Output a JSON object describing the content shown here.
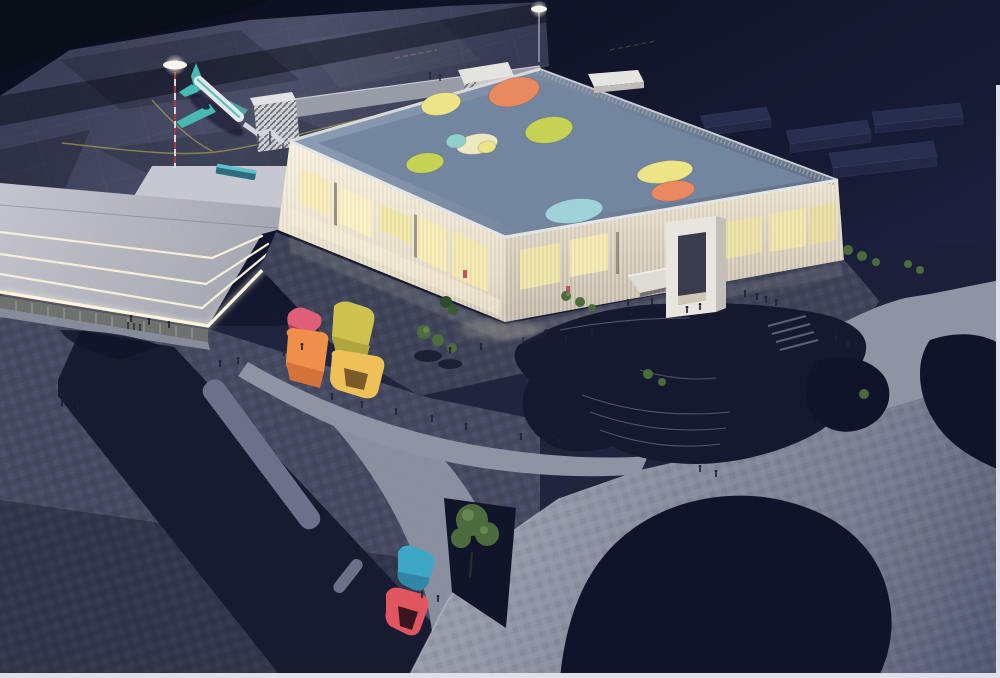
{
  "scene": {
    "subject": "night aerial architectural rendering of an airport terminal with colorful roof skylights, apron with airplane, plaza pavilions and parametric landscape",
    "elements": [
      "night-sky",
      "airport-apron",
      "taxiway-lines",
      "background-warehouses",
      "low-terminal-wing",
      "illuminated-fascia",
      "bus",
      "white-platform",
      "airplane",
      "jet-bridge",
      "striped-pier-box",
      "apron-light-mast",
      "tall-light-pole",
      "main-terminal",
      "louvered-facade",
      "entrance-portal",
      "entrance-canopy",
      "roof-deck",
      "roof-skylights",
      "rooftop-bulkhead",
      "forecourt-plaza",
      "curved-pedestrian-paths",
      "dark-road-strip",
      "median-strip",
      "terraced-hill",
      "paved-platform",
      "dark-lawn-islands",
      "trees",
      "art-pavilions-cluster",
      "teal-pavilion",
      "red-pavilion",
      "pedestrians",
      "page-edge"
    ],
    "colors": {
      "sky_top": "#0a0d1e",
      "sky_bottom": "#272e52",
      "apron": "#474c66",
      "apron_shadow": "#33374e",
      "taxi_line": "#b5a54d",
      "background_block": "#2c3356",
      "left_roof": "#c0c2ca",
      "light_strip": "#f6eed8",
      "fascia_glow": "#fdf5dd",
      "glass_band": "#6f716f",
      "platform_white": "#c6c8cf",
      "bus_body": "#2e6d80",
      "bus_teal": "#5fc3cb",
      "plane_body": "#e6e9ec",
      "plane_teal": "#49b9b4",
      "pole_red": "#b03a3a",
      "pole_light": "#f8f6ea",
      "roof_deck": "#7a8da6",
      "parapet": "#d7d9dd",
      "facade_sw_light": "#f6efdd",
      "facade_sw_shade": "#c9bfae",
      "facade_se_light": "#e8e0cc",
      "facade_se_shade": "#bdb4a4",
      "window_glow": "#f6eab0",
      "accent_red": "#c4525e",
      "portal_white": "#e8e5df",
      "portal_side": "#c2bfb9",
      "portal_opening": "#3a3d4e",
      "canopy": "#dfdcd6",
      "skylight_orange": "#e8895f",
      "skylight_yellow": "#ece487",
      "skylight_green": "#c6d254",
      "skylight_blue": "#9fd2d8",
      "skylight_cream": "#ede9c2",
      "skylight_teal": "#8fd0c8",
      "plaza": "#3e4359",
      "path_light": "#8e94a4",
      "paving_left": "#454a63",
      "road_dark": "#171b30",
      "median": "#6b7188",
      "platform_light": "#979cab",
      "platform_shade": "#4e5570",
      "lawn_dark": "#10142a",
      "hill_dark": "#151930",
      "contour": "#5d647c",
      "tree_green": "#4c6b3e",
      "tree_light": "#6c9054",
      "tree_bed": "#11152a",
      "pavilion_pink": "#e05f78",
      "pavilion_pink_shade": "#b83c5a",
      "pavilion_orange": "#ef8f4a",
      "pavilion_orange_shade": "#d4743a",
      "pavilion_olive": "#cfc14e",
      "pavilion_olive_shade": "#b0a53e",
      "pavilion_yellow": "#eec058",
      "pavilion_yellow_dark": "#7a5c28",
      "pavilion_teal": "#3ea6c6",
      "pavilion_teal_shade": "#2f87a5",
      "pavilion_red": "#df5560",
      "pavilion_red_dark": "#3a1620",
      "people": "#1e2334",
      "page_edge": "#dde0e6"
    }
  }
}
